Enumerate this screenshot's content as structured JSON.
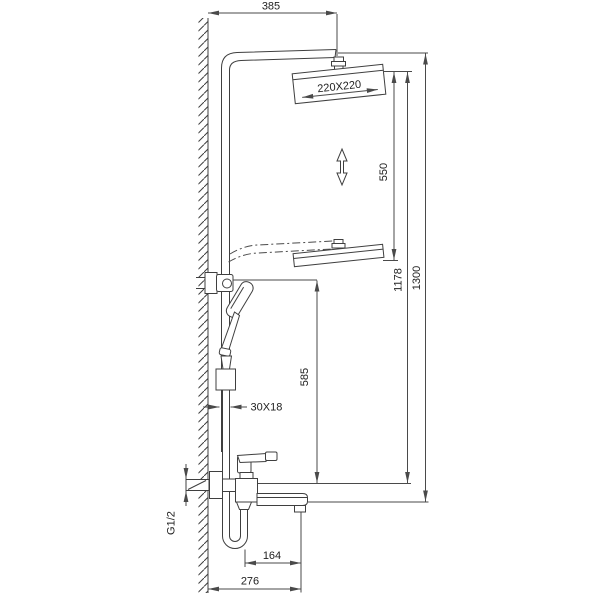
{
  "drawing": {
    "colors": {
      "line": "#3f3f3f",
      "dimension_line": "#4a4a4a",
      "text": "#222222",
      "background": "#ffffff"
    },
    "labels": {
      "wall_to_head_width": "385",
      "head_size": "220X220",
      "slide_range": "550",
      "head_height": "1178",
      "total_height": "1300",
      "bracket_to_outlet": "585",
      "pole_section": "30X18",
      "inlet_thread": "G1/2",
      "hose_to_spout": "164",
      "wall_to_spout": "276"
    }
  }
}
